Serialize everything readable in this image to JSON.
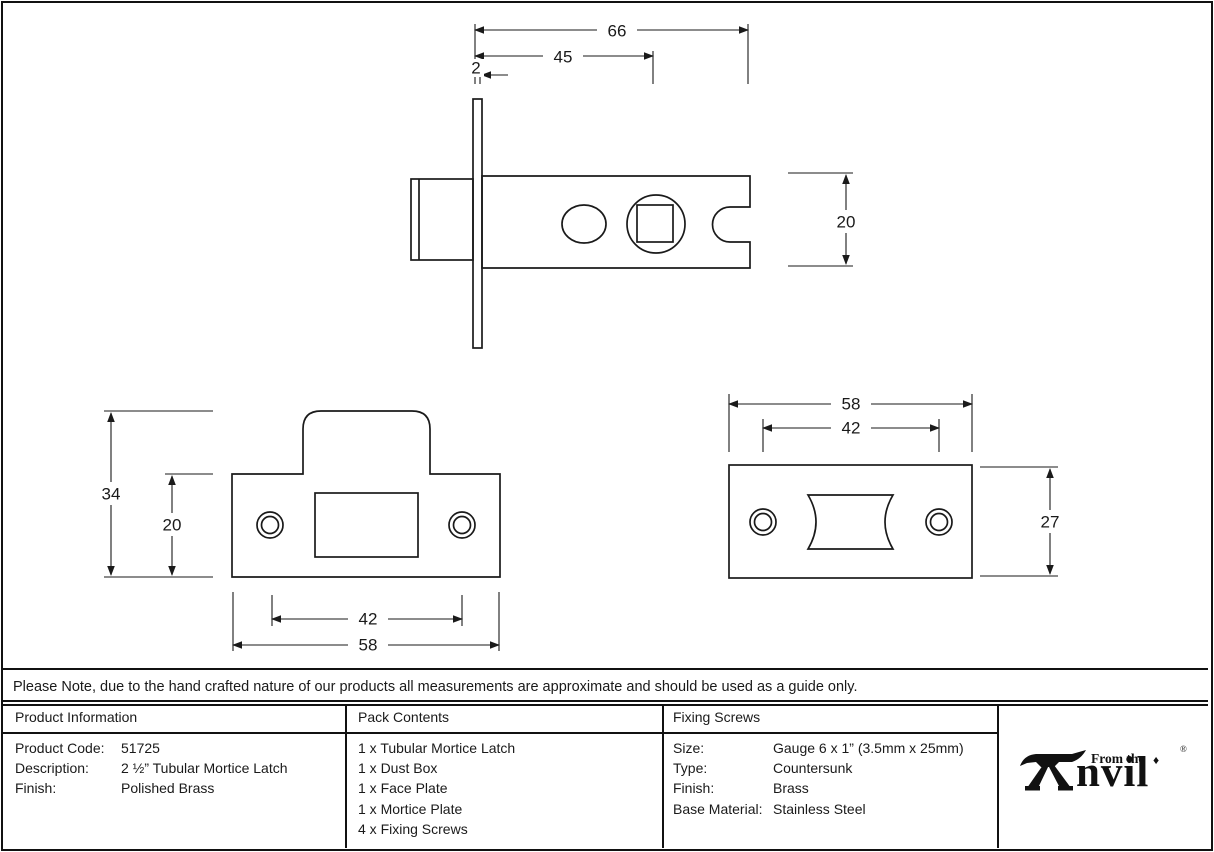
{
  "sheet": {
    "note": "Please Note, due to the hand crafted nature of our products all measurements are approximate and should be used as a guide only."
  },
  "drawings": {
    "side_view": {
      "dim_overall_length": "66",
      "dim_backset": "45",
      "dim_faceplate_thickness": "2",
      "dim_case_height": "20"
    },
    "strike_plate": {
      "dim_overall_height": "34",
      "dim_plate_height": "20",
      "dim_screw_centres": "42",
      "dim_width": "58"
    },
    "face_plate": {
      "dim_width": "58",
      "dim_screw_centres": "42",
      "dim_height": "27"
    }
  },
  "table": {
    "product_information": {
      "header": "Product Information",
      "rows": [
        {
          "label": "Product Code:",
          "value": "51725"
        },
        {
          "label": "Description:",
          "value": "2 ½” Tubular Mortice Latch"
        },
        {
          "label": "Finish:",
          "value": "Polished Brass"
        }
      ]
    },
    "pack_contents": {
      "header": "Pack Contents",
      "items": [
        "1 x Tubular Mortice Latch",
        "1 x Dust Box",
        "1 x Face Plate",
        "1 x Mortice Plate",
        "4 x Fixing Screws"
      ]
    },
    "fixing_screws": {
      "header": "Fixing Screws",
      "rows": [
        {
          "label": "Size:",
          "value": "Gauge 6 x 1” (3.5mm x 25mm)"
        },
        {
          "label": "Type:",
          "value": "Countersunk"
        },
        {
          "label": "Finish:",
          "value": "Brass"
        },
        {
          "label": "Base Material:",
          "value": "Stainless Steel"
        }
      ]
    }
  },
  "logo": {
    "prefix": "From the",
    "diamond": "♦",
    "word": "nvil",
    "registered": "®"
  },
  "colors": {
    "line": "#1a1a1a",
    "background": "#ffffff"
  }
}
